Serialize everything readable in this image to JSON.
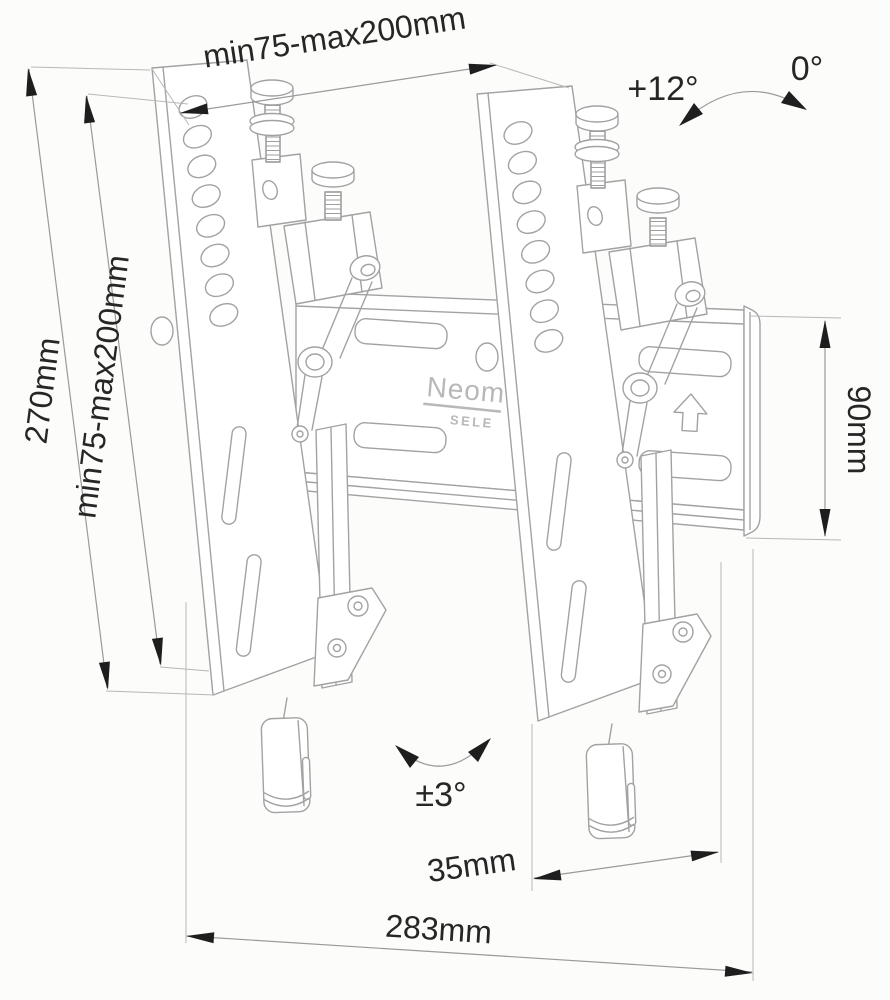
{
  "diagram": {
    "type": "technical-drawing",
    "subject": "tilting tv wall mount, isometric line drawing with dimensions"
  },
  "dimensions": {
    "vesa_width": "min75-max200mm",
    "bracket_height": "270mm",
    "vesa_height": "min75-max200mm",
    "plate_height": "90mm",
    "depth_offset": "35mm",
    "plate_width": "283mm"
  },
  "angles": {
    "tilt_max": "+12°",
    "tilt_zero": "0°",
    "swivel": "±3°"
  },
  "brand": {
    "logo_visible": "Neom",
    "logo_sub_visible": "SELE"
  },
  "icons": {
    "up_arrow": "up-arrow-icon"
  },
  "colors": {
    "background": "#fcfcfb",
    "product_line": "#a2a2a2",
    "dimension_line": "#9a9a9a",
    "dimension_text": "#262626",
    "arrowhead": "#1e1e1e",
    "brand_text": "#b8b8b8"
  }
}
